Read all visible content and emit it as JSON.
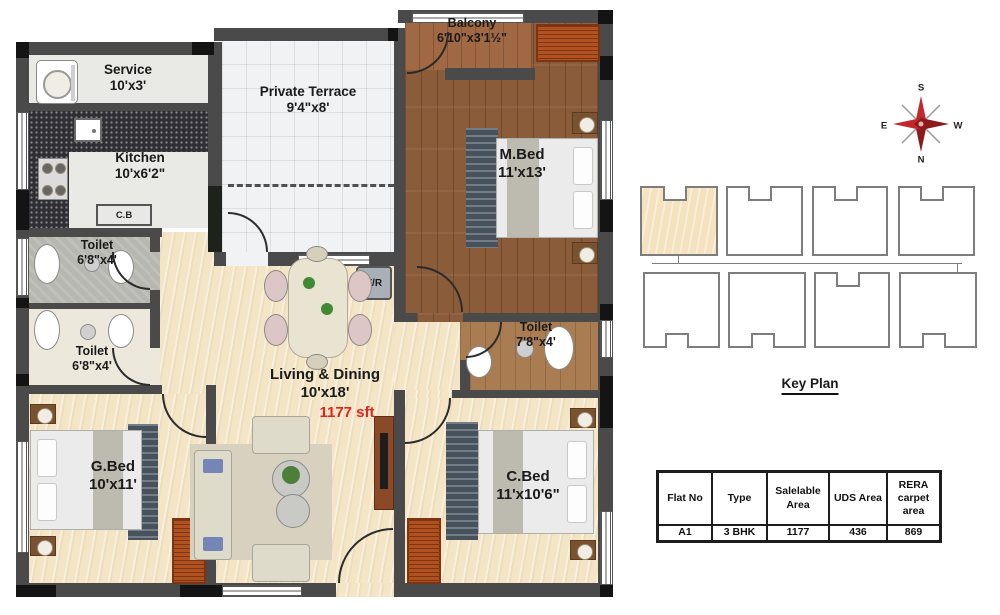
{
  "rooms": {
    "service": {
      "name": "Service",
      "dim": "10'x3'"
    },
    "kitchen": {
      "name": "Kitchen",
      "dim": "10'x6'2\""
    },
    "terrace": {
      "name": "Private Terrace",
      "dim": "9'4\"x8'"
    },
    "balcony": {
      "name": "Balcony",
      "dim": "6'10\"x3'1½\""
    },
    "mbed": {
      "name": "M.Bed",
      "dim": "11'x13'"
    },
    "toilet_top": {
      "name": "Toilet",
      "dim": "6'8\"x4'"
    },
    "toilet_mid": {
      "name": "Toilet",
      "dim": "6'8\"x4'"
    },
    "gbed": {
      "name": "G.Bed",
      "dim": "10'x11'"
    },
    "living": {
      "name": "Living & Dining",
      "dim": "10'x18'"
    },
    "toilet_right": {
      "name": "Toilet",
      "dim": "7'8\"x4'"
    },
    "cbed": {
      "name": "C.Bed",
      "dim": "11'x10'6\""
    }
  },
  "annotations": {
    "total_area": "1177 sft",
    "cabinet": "C.B",
    "fridge": "F/R"
  },
  "compass": {
    "n": "N",
    "s": "S",
    "e": "E",
    "w": "W"
  },
  "key_plan": {
    "title": "Key Plan",
    "highlighted_unit": "A1"
  },
  "table": {
    "headers": [
      "Flat No",
      "Type",
      "Salelable Area",
      "UDS Area",
      "RERA carpet area"
    ],
    "row": [
      "A1",
      "3 BHK",
      "1177",
      "436",
      "869"
    ]
  },
  "colors": {
    "wall": "#4a4a4a",
    "wood_floor": "#8a5c3a",
    "marble_floor": "#f3e5c6",
    "wardrobe": "#b0511f",
    "area_text": "#e02420",
    "highlight_unit": "#f5e2bf"
  }
}
